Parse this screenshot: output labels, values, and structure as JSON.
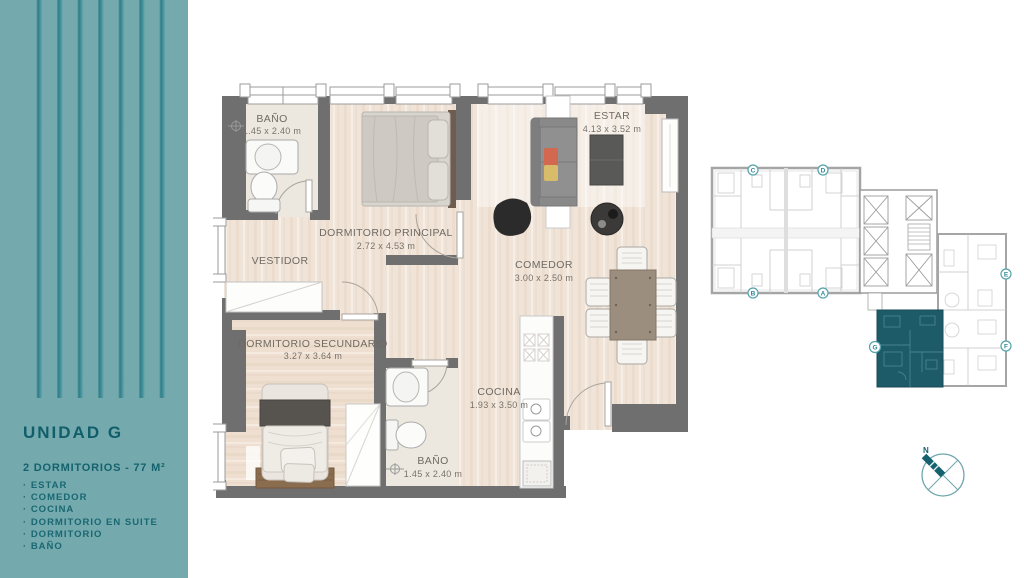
{
  "sidebar": {
    "title": "UNIDAD G",
    "subtitle": "2 DORMITORIOS - 77 M²",
    "features": [
      "ESTAR",
      "COMEDOR",
      "COCINA",
      "DORMITORIO EN SUITE",
      "DORMITORIO",
      "BAÑO"
    ],
    "colors": {
      "background": "#74AAAE",
      "stripe": "#3E8A94",
      "text": "#115E6B"
    }
  },
  "floorplan": {
    "rooms": [
      {
        "name": "BAÑO",
        "dims": "1.45 x 2.40 m"
      },
      {
        "name": "DORMITORIO PRINCIPAL",
        "dims": "2.72 x 4.53 m"
      },
      {
        "name": "VESTIDOR",
        "dims": ""
      },
      {
        "name": "ESTAR",
        "dims": "4.13 x 3.52 m"
      },
      {
        "name": "COMEDOR",
        "dims": "3.00 x 2.50 m"
      },
      {
        "name": "DORMITORIO SECUNDARIO",
        "dims": "3.27 x 3.64 m"
      },
      {
        "name": "COCINA",
        "dims": "1.93 x 3.50 m"
      },
      {
        "name": "BAÑO",
        "dims": "1.45 x 2.40 m"
      }
    ],
    "colors": {
      "wall": "#6F6F6F",
      "wood_floor": "#F0E3D8",
      "tile_floor": "#ECE8DF"
    }
  },
  "keyplan": {
    "highlighted_unit": "G",
    "unit_labels": [
      "C",
      "D",
      "B",
      "A",
      "E",
      "F",
      "G"
    ],
    "highlight_color": "#1E5B69"
  },
  "compass": {
    "north_label": "N"
  }
}
